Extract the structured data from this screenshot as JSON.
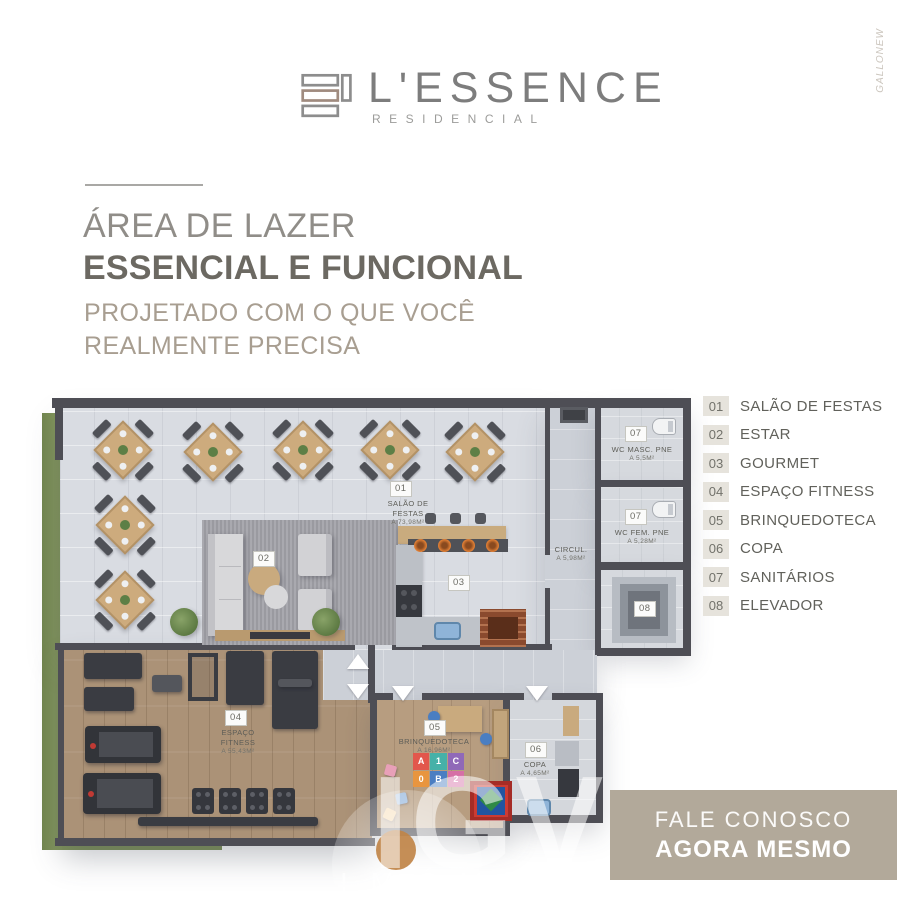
{
  "brand": {
    "name": "L'ESSENCE",
    "subtitle": "RESIDENCIAL"
  },
  "artist_watermark": "GALLONEW",
  "headline": {
    "line1": "ÁREA DE LAZER",
    "line2": "ESSENCIAL E FUNCIONAL",
    "sub_line1": "PROJETADO COM O QUE VOCÊ",
    "sub_line2": "REALMENTE PRECISA"
  },
  "legend": {
    "items": [
      {
        "num": "01",
        "label": "SALÃO DE FESTAS"
      },
      {
        "num": "02",
        "label": "ESTAR"
      },
      {
        "num": "03",
        "label": "GOURMET"
      },
      {
        "num": "04",
        "label": "ESPAÇO FITNESS"
      },
      {
        "num": "05",
        "label": "BRINQUEDOTECA"
      },
      {
        "num": "06",
        "label": "COPA"
      },
      {
        "num": "07",
        "label": "SANITÁRIOS"
      },
      {
        "num": "08",
        "label": "ELEVADOR"
      }
    ]
  },
  "plan": {
    "salao": {
      "num": "01",
      "name1": "SALÃO DE",
      "name2": "FESTAS",
      "area": "A 73,98m²"
    },
    "estar": {
      "num": "02"
    },
    "gourmet": {
      "num": "03"
    },
    "fitness": {
      "num": "04",
      "name1": "ESPAÇO",
      "name2": "FITNESS",
      "area": "A 55,43m²"
    },
    "brinquedoteca": {
      "num": "05",
      "name": "BRINQUEDOTECA",
      "area": "A 16,96m²"
    },
    "copa": {
      "num": "06",
      "name": "COPA",
      "area": "A 4,65m²"
    },
    "wc_masc": {
      "num": "07",
      "name": "WC MASC. PNE",
      "area": "A 5,5m²"
    },
    "wc_fem": {
      "num": "07",
      "name": "WC FEM. PNE",
      "area": "A 5,28m²"
    },
    "elevador": {
      "num": "08"
    },
    "circulacao": {
      "name": "CIRCUL.",
      "area": "A 5,98m²"
    },
    "play_mat_letters": [
      "A",
      "1",
      "C",
      "0",
      "B",
      "2"
    ]
  },
  "watermark": {
    "letters": "IGV",
    "word": "IMÓVEIS"
  },
  "cta": {
    "line1": "FALE CONOSCO",
    "line2": "AGORA MESMO"
  },
  "colors": {
    "accent_beige": "#b2a99a",
    "legend_badge_bg": "#e6e3dc",
    "wall": "#4e4e55",
    "wood_floor": "#ab9277",
    "grass": "#7e9159"
  }
}
